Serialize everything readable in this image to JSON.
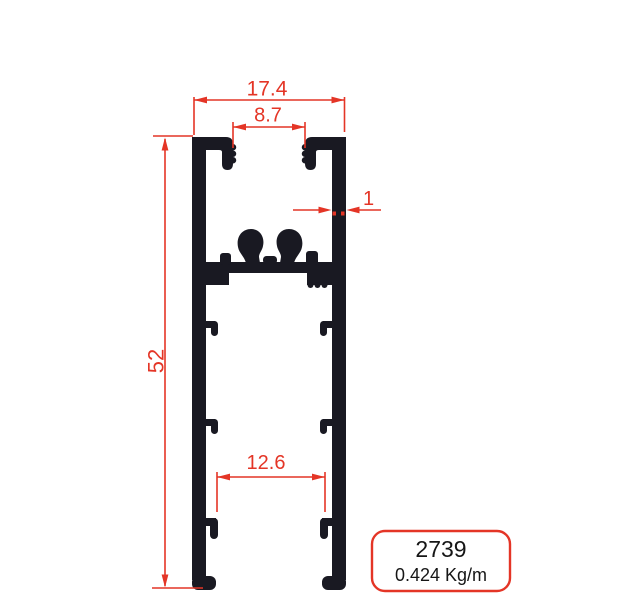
{
  "drawing": {
    "dimensions": {
      "top_width": "17.4",
      "top_slot_width": "8.7",
      "wall_thickness": "1",
      "height": "52",
      "bottom_slot_width": "12.6"
    },
    "label": {
      "profile_code": "2739",
      "weight": "0.424 Kg/m"
    },
    "colors": {
      "dimension_red": "#e43526",
      "profile_black": "#191922",
      "label_text": "#161616",
      "background": "#ffffff"
    }
  }
}
